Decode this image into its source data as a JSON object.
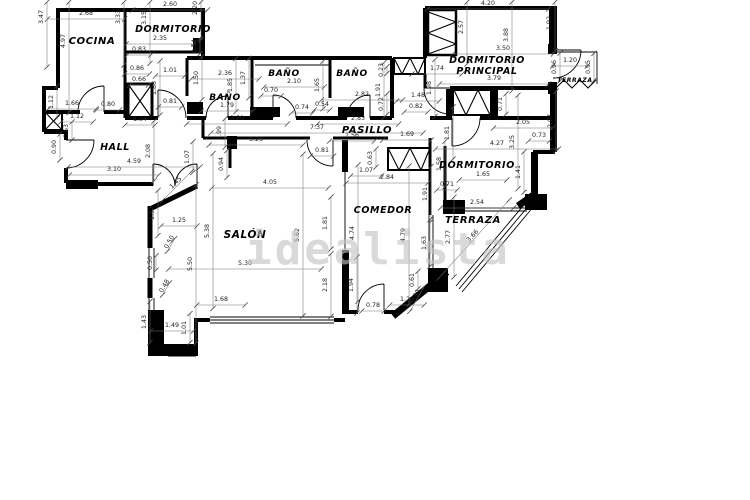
{
  "watermark": {
    "text": "idealista"
  },
  "meta": {
    "scale_px_per_m": 28.8,
    "units": "m"
  },
  "rooms": [
    {
      "label": "COCINA",
      "x": 92,
      "y": 44,
      "fs": 10
    },
    {
      "label": "DORMITORIO",
      "x": 173,
      "y": 32,
      "fs": 9.5
    },
    {
      "label": "BAÑO",
      "x": 225,
      "y": 100,
      "fs": 9
    },
    {
      "label": "BAÑO",
      "x": 284,
      "y": 76,
      "fs": 9
    },
    {
      "label": "BAÑO",
      "x": 352,
      "y": 76,
      "fs": 9
    },
    {
      "label": "PASILLO",
      "x": 367,
      "y": 133,
      "fs": 10
    },
    {
      "label": "HALL",
      "x": 115,
      "y": 150,
      "fs": 9.5
    },
    {
      "label": "DORMITORIO",
      "x": 487,
      "y": 63,
      "fs": 9.5
    },
    {
      "label": "PRINCIPAL",
      "x": 487,
      "y": 74,
      "fs": 9.5
    },
    {
      "label": "TERRAZA",
      "x": 575,
      "y": 82,
      "fs": 6
    },
    {
      "label": "DORMITORIO",
      "x": 477,
      "y": 168,
      "fs": 9.5
    },
    {
      "label": "COMEDOR",
      "x": 383,
      "y": 213,
      "fs": 9.5
    },
    {
      "label": "SALÓN",
      "x": 245,
      "y": 238,
      "fs": 10.5
    },
    {
      "label": "TERRAZA",
      "x": 473,
      "y": 223,
      "fs": 10
    }
  ],
  "dimensions": [
    {
      "v": "2.68",
      "x": 86,
      "y": 15,
      "r": 0
    },
    {
      "v": "3.47",
      "x": 43,
      "y": 17,
      "r": -90
    },
    {
      "v": "4.97",
      "x": 65,
      "y": 41,
      "r": -90
    },
    {
      "v": "3.33",
      "x": 120,
      "y": 17,
      "r": -90
    },
    {
      "v": "3.15",
      "x": 146,
      "y": 18,
      "r": -90
    },
    {
      "v": "2.60",
      "x": 170,
      "y": 6,
      "r": 0
    },
    {
      "v": "2.20",
      "x": 197,
      "y": 8,
      "r": -90
    },
    {
      "v": "2.35",
      "x": 160,
      "y": 40,
      "r": 0
    },
    {
      "v": "0.54",
      "x": 196,
      "y": 46,
      "r": -90
    },
    {
      "v": "0.83",
      "x": 139,
      "y": 51,
      "r": 0
    },
    {
      "v": "0.86",
      "x": 137,
      "y": 70,
      "r": 0
    },
    {
      "v": "1.01",
      "x": 170,
      "y": 72,
      "r": 0
    },
    {
      "v": "0.66",
      "x": 139,
      "y": 81,
      "r": 0
    },
    {
      "v": "1.88",
      "x": 156,
      "y": 88,
      "r": -90
    },
    {
      "v": "2.36",
      "x": 225,
      "y": 75,
      "r": 0
    },
    {
      "v": "1.50",
      "x": 198,
      "y": 78,
      "r": -90
    },
    {
      "v": "1.85",
      "x": 232,
      "y": 85,
      "r": -90
    },
    {
      "v": "1.37",
      "x": 245,
      "y": 78,
      "r": -90
    },
    {
      "v": "1.79",
      "x": 227,
      "y": 107,
      "r": 0
    },
    {
      "v": "0.80",
      "x": 108,
      "y": 106,
      "r": 0
    },
    {
      "v": "1.66",
      "x": 72,
      "y": 105,
      "r": 0
    },
    {
      "v": "1.12",
      "x": 53,
      "y": 102,
      "r": -90
    },
    {
      "v": "1.12",
      "x": 77,
      "y": 118,
      "r": 0
    },
    {
      "v": "0.63",
      "x": 68,
      "y": 131,
      "r": -90
    },
    {
      "v": "1.04",
      "x": 140,
      "y": 121,
      "r": 0
    },
    {
      "v": "0.81",
      "x": 170,
      "y": 103,
      "r": 0
    },
    {
      "v": "0.90",
      "x": 56,
      "y": 147,
      "r": -90
    },
    {
      "v": "2.08",
      "x": 150,
      "y": 151,
      "r": -90
    },
    {
      "v": "4.59",
      "x": 134,
      "y": 163,
      "r": 0
    },
    {
      "v": "3.10",
      "x": 114,
      "y": 171,
      "r": 0
    },
    {
      "v": "1.07",
      "x": 189,
      "y": 157,
      "r": -90
    },
    {
      "v": "1.45",
      "x": 177,
      "y": 184,
      "r": -45
    },
    {
      "v": "0.99",
      "x": 221,
      "y": 133,
      "r": -90
    },
    {
      "v": "3.26",
      "x": 256,
      "y": 141,
      "r": 0
    },
    {
      "v": "0.94",
      "x": 223,
      "y": 164,
      "r": -90
    },
    {
      "v": "0.81",
      "x": 322,
      "y": 152,
      "r": 0
    },
    {
      "v": "4.05",
      "x": 270,
      "y": 184,
      "r": 0
    },
    {
      "v": "3.50",
      "x": 237,
      "y": 120,
      "r": 0
    },
    {
      "v": "7.37",
      "x": 317,
      "y": 129,
      "r": 0
    },
    {
      "v": "2.10",
      "x": 294,
      "y": 83,
      "r": 0
    },
    {
      "v": "0.70",
      "x": 271,
      "y": 92,
      "r": 0
    },
    {
      "v": "1.65",
      "x": 319,
      "y": 85,
      "r": -90
    },
    {
      "v": "0.74",
      "x": 302,
      "y": 109,
      "r": 0
    },
    {
      "v": "0.54",
      "x": 322,
      "y": 106,
      "r": 0
    },
    {
      "v": "2.82",
      "x": 362,
      "y": 96,
      "r": 0
    },
    {
      "v": "0.23",
      "x": 383,
      "y": 70,
      "r": -90
    },
    {
      "v": "1.91",
      "x": 380,
      "y": 90,
      "r": -90
    },
    {
      "v": "0.72",
      "x": 383,
      "y": 104,
      "r": -90
    },
    {
      "v": "2.83",
      "x": 358,
      "y": 120,
      "r": 0
    },
    {
      "v": "1.56",
      "x": 352,
      "y": 137,
      "r": 0
    },
    {
      "v": "1.69",
      "x": 407,
      "y": 136,
      "r": 0
    },
    {
      "v": "4.20",
      "x": 488,
      "y": 5,
      "r": 0
    },
    {
      "v": "2.57",
      "x": 463,
      "y": 27,
      "r": -90
    },
    {
      "v": "3.88",
      "x": 508,
      "y": 35,
      "r": -90
    },
    {
      "v": "3.50",
      "x": 503,
      "y": 50,
      "r": 0
    },
    {
      "v": "1.92",
      "x": 551,
      "y": 23,
      "r": -90
    },
    {
      "v": "1.74",
      "x": 437,
      "y": 70,
      "r": 0
    },
    {
      "v": "1.20",
      "x": 570,
      "y": 62,
      "r": 0
    },
    {
      "v": "0.96",
      "x": 556,
      "y": 67,
      "r": -90
    },
    {
      "v": "0.95",
      "x": 590,
      "y": 67,
      "r": -90
    },
    {
      "v": "3.79",
      "x": 494,
      "y": 80,
      "r": 0
    },
    {
      "v": "1.98",
      "x": 431,
      "y": 88,
      "r": -90
    },
    {
      "v": "1.48",
      "x": 418,
      "y": 97,
      "r": 0
    },
    {
      "v": "0.82",
      "x": 416,
      "y": 108,
      "r": 0
    },
    {
      "v": "0.71",
      "x": 502,
      "y": 104,
      "r": -90
    },
    {
      "v": "2.05",
      "x": 523,
      "y": 124,
      "r": 0
    },
    {
      "v": "2.07",
      "x": 552,
      "y": 121,
      "r": -90
    },
    {
      "v": "0.73",
      "x": 539,
      "y": 137,
      "r": 0
    },
    {
      "v": "4.27",
      "x": 497,
      "y": 145,
      "r": 0
    },
    {
      "v": "3.25",
      "x": 514,
      "y": 142,
      "r": -90
    },
    {
      "v": "1.81",
      "x": 449,
      "y": 133,
      "r": -90
    },
    {
      "v": "1.58",
      "x": 441,
      "y": 164,
      "r": -90
    },
    {
      "v": "0.71",
      "x": 447,
      "y": 186,
      "r": 0
    },
    {
      "v": "1.65",
      "x": 483,
      "y": 176,
      "r": 0
    },
    {
      "v": "1.41",
      "x": 520,
      "y": 172,
      "r": -90
    },
    {
      "v": "2.54",
      "x": 477,
      "y": 204,
      "r": 0
    },
    {
      "v": "0.63",
      "x": 372,
      "y": 158,
      "r": -90
    },
    {
      "v": "1.07",
      "x": 366,
      "y": 172,
      "r": 0
    },
    {
      "v": "2.84",
      "x": 387,
      "y": 179,
      "r": 0
    },
    {
      "v": "1.91",
      "x": 427,
      "y": 194,
      "r": -90
    },
    {
      "v": "1.57",
      "x": 154,
      "y": 213,
      "r": -90
    },
    {
      "v": "1.25",
      "x": 179,
      "y": 222,
      "r": 0
    },
    {
      "v": "5.38",
      "x": 209,
      "y": 231,
      "r": -90
    },
    {
      "v": "5.62",
      "x": 299,
      "y": 235,
      "r": -90
    },
    {
      "v": "1.81",
      "x": 327,
      "y": 223,
      "r": -90
    },
    {
      "v": "4.74",
      "x": 354,
      "y": 233,
      "r": -90
    },
    {
      "v": "0.50",
      "x": 152,
      "y": 263,
      "r": -90
    },
    {
      "v": "0.50",
      "x": 171,
      "y": 243,
      "r": -60
    },
    {
      "v": "5.50",
      "x": 192,
      "y": 264,
      "r": -90
    },
    {
      "v": "5.30",
      "x": 245,
      "y": 265,
      "r": 0
    },
    {
      "v": "0.48",
      "x": 166,
      "y": 287,
      "r": -60
    },
    {
      "v": "2.18",
      "x": 327,
      "y": 285,
      "r": -90
    },
    {
      "v": "1.94",
      "x": 353,
      "y": 285,
      "r": -90
    },
    {
      "v": "1.68",
      "x": 221,
      "y": 301,
      "r": 0
    },
    {
      "v": "1.43",
      "x": 146,
      "y": 322,
      "r": -90
    },
    {
      "v": "1.49",
      "x": 172,
      "y": 327,
      "r": 0
    },
    {
      "v": "1.01",
      "x": 186,
      "y": 328,
      "r": -90
    },
    {
      "v": "4.79",
      "x": 405,
      "y": 235,
      "r": -90
    },
    {
      "v": "1.63",
      "x": 426,
      "y": 243,
      "r": -90
    },
    {
      "v": "2.77",
      "x": 450,
      "y": 237,
      "r": -90
    },
    {
      "v": "0.78",
      "x": 373,
      "y": 307,
      "r": 0
    },
    {
      "v": "1.20",
      "x": 407,
      "y": 301,
      "r": 0
    },
    {
      "v": "0.99",
      "x": 417,
      "y": 297,
      "r": -60
    },
    {
      "v": "0.61",
      "x": 414,
      "y": 280,
      "r": -90
    },
    {
      "v": "3.66",
      "x": 474,
      "y": 237,
      "r": -48
    }
  ]
}
